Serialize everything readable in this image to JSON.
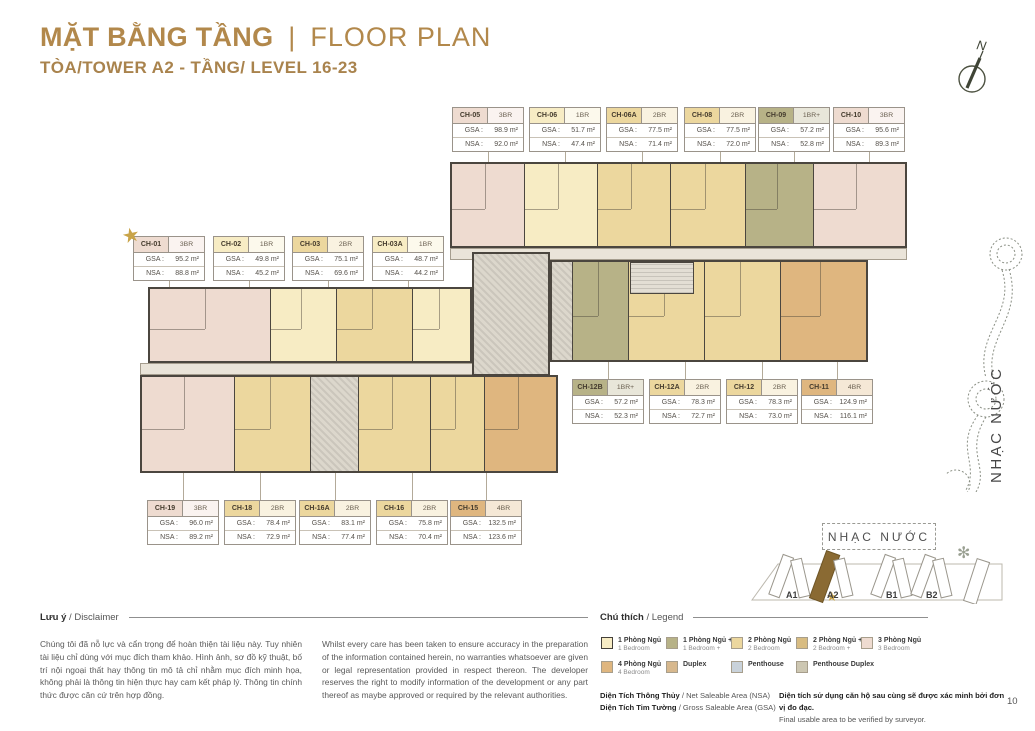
{
  "header": {
    "title_bold": "MẶT BẰNG TẦNG",
    "title_divider": "|",
    "title_light": "FLOOR PLAN",
    "subtitle": "TÒA/TOWER A2 - TẦNG/ LEVEL 16-23"
  },
  "compass": {
    "north": "N"
  },
  "plan": {
    "gsa_label": "GSA :",
    "nsa_label": "NSA :",
    "units": [
      {
        "id": "CH-01",
        "type": "3BR",
        "gsa": "95.2 m²",
        "nsa": "88.8 m²",
        "featured": true
      },
      {
        "id": "CH-02",
        "type": "1BR",
        "gsa": "49.8 m²",
        "nsa": "45.2 m²"
      },
      {
        "id": "CH-03",
        "type": "2BR",
        "gsa": "75.1 m²",
        "nsa": "69.6 m²"
      },
      {
        "id": "CH-03A",
        "type": "1BR",
        "gsa": "48.7 m²",
        "nsa": "44.2 m²"
      },
      {
        "id": "CH-05",
        "type": "3BR",
        "gsa": "98.9 m²",
        "nsa": "92.0 m²"
      },
      {
        "id": "CH-06",
        "type": "1BR",
        "gsa": "51.7 m²",
        "nsa": "47.4 m²"
      },
      {
        "id": "CH-06A",
        "type": "2BR",
        "gsa": "77.5 m²",
        "nsa": "71.4 m²"
      },
      {
        "id": "CH-08",
        "type": "2BR",
        "gsa": "77.5 m²",
        "nsa": "72.0 m²"
      },
      {
        "id": "CH-09",
        "type": "1BR+",
        "gsa": "57.2 m²",
        "nsa": "52.8 m²"
      },
      {
        "id": "CH-10",
        "type": "3BR",
        "gsa": "95.6 m²",
        "nsa": "89.3 m²"
      },
      {
        "id": "CH-11",
        "type": "4BR",
        "gsa": "124.9 m²",
        "nsa": "116.1 m²"
      },
      {
        "id": "CH-12",
        "type": "2BR",
        "gsa": "78.3 m²",
        "nsa": "73.0 m²"
      },
      {
        "id": "CH-12A",
        "type": "2BR",
        "gsa": "78.3 m²",
        "nsa": "72.7 m²"
      },
      {
        "id": "CH-12B",
        "type": "1BR+",
        "gsa": "57.2 m²",
        "nsa": "52.3 m²"
      },
      {
        "id": "CH-15",
        "type": "4BR",
        "gsa": "132.5 m²",
        "nsa": "123.6 m²"
      },
      {
        "id": "CH-16",
        "type": "2BR",
        "gsa": "75.8 m²",
        "nsa": "70.4 m²"
      },
      {
        "id": "CH-16A",
        "type": "2BR",
        "gsa": "83.1 m²",
        "nsa": "77.4 m²"
      },
      {
        "id": "CH-18",
        "type": "2BR",
        "gsa": "78.4 m²",
        "nsa": "72.9 m²"
      },
      {
        "id": "CH-19",
        "type": "3BR",
        "gsa": "96.0 m²",
        "nsa": "89.2 m²"
      }
    ]
  },
  "type_colors": {
    "1BR": "#f7ecc4",
    "1BR+": "#b7b287",
    "2BR": "#ecd79e",
    "2BR+": "#d8bc82",
    "3BR": "#eedbd0",
    "4BR": "#dfb67f",
    "DUPLEX": "#d7b88d",
    "PENTHOUSE": "#c9d2da",
    "PENTHOUSE_DUPLEX": "#cdc7b2"
  },
  "disclaimer": {
    "heading": "Lưu ý",
    "heading_rest": " / Disclaimer",
    "text_vi": "Chúng tôi đã nỗ lực và cẩn trọng để hoàn thiện tài liệu này. Tuy nhiên tài liệu chỉ dùng với mục đích tham khảo. Hình ảnh, sơ đồ kỹ thuật, bố trí nội ngoại thất hay thông tin mô tả chỉ nhằm mục đích minh họa, không phải là thông tin hiện thực hay cam kết pháp lý. Thông tin chính thức được căn cứ trên hợp đồng.",
    "text_en": "Whilst every care has been taken to ensure accuracy in the preparation of the information contained herein, no warranties whatsoever are given or legal representation provided in respect thereon. The developer reserves the right to modify information of the development or any part thereof as maybe approved or required by the relevant authorities."
  },
  "legend": {
    "heading": "Chú thích",
    "heading_rest": " / Legend",
    "items": [
      {
        "vi": "1 Phòng Ngủ",
        "en": "1 Bedroom",
        "color": "#f7ecc4"
      },
      {
        "vi": "1 Phòng Ngủ +",
        "en": "1 Bedroom +",
        "color": "#b7b287"
      },
      {
        "vi": "2 Phòng Ngủ",
        "en": "2 Bedroom",
        "color": "#ecd79e"
      },
      {
        "vi": "2 Phòng Ngủ +",
        "en": "2 Bedroom +",
        "color": "#d8bc82"
      },
      {
        "vi": "3 Phòng Ngủ",
        "en": "3 Bedroom",
        "color": "#eedbd0"
      },
      {
        "vi": "4 Phòng Ngủ",
        "en": "4 Bedroom",
        "color": "#dfb67f"
      },
      {
        "vi": "Duplex",
        "en": "",
        "color": "#d7b88d"
      },
      {
        "vi": "Penthouse",
        "en": "",
        "color": "#c9d2da"
      },
      {
        "vi": "Penthouse Duplex",
        "en": "",
        "color": "#cdc7b2"
      }
    ]
  },
  "area_notes": {
    "nsa_bold": "Diện Tích Thông Thủy",
    "nsa_rest": " / Net Saleable Area (NSA)",
    "gsa_bold": "Diện Tích Tim Tường",
    "gsa_rest": " / Gross Saleable Area (GSA)",
    "note_bold": "Diện tích sử dụng căn hộ sau cùng sẽ được xác minh bởi đơn vị đo đạc.",
    "note_rest": "Final usable area to be verified by surveyor."
  },
  "siteplan": {
    "label": "NHẠC NƯỚC",
    "towers": [
      "A1",
      "A2",
      "B1",
      "B2"
    ]
  },
  "side_label": "NHẠC NƯỚC",
  "page_number": "10"
}
